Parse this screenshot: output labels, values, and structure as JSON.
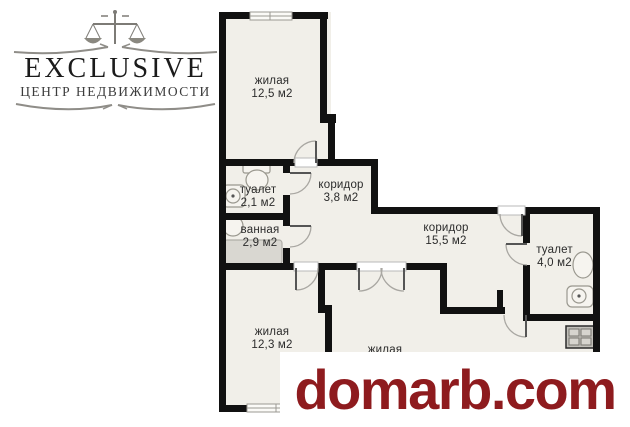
{
  "logo": {
    "brand": "EXCLUSIVE",
    "tagline": "ЦЕНТР НЕДВИЖИМОСТИ"
  },
  "watermark": {
    "text": "domarb.com",
    "color": "#8e1b1e"
  },
  "floorplan": {
    "colors": {
      "wall": "#111111",
      "floor": "#f1efe9",
      "fixture_stroke": "#9a988f",
      "bathtub_fill": "#d9d7d1",
      "door_arc": "#a9a7a2"
    },
    "rooms": [
      {
        "label": "жилая",
        "area": "12,5 м2"
      },
      {
        "label": "туалет",
        "area": "2,1 м2"
      },
      {
        "label": "коридор",
        "area": "3,8 м2"
      },
      {
        "label": "ванная",
        "area": "2,9 м2"
      },
      {
        "label": "коридор",
        "area": "15,5 м2"
      },
      {
        "label": "туалет",
        "area": "4,0 м2"
      },
      {
        "label": "жилая",
        "area": "12,3 м2"
      },
      {
        "label": "жилая",
        "area": ""
      }
    ]
  }
}
